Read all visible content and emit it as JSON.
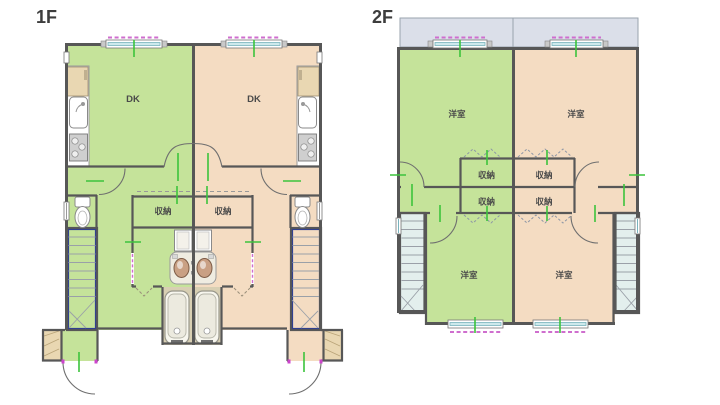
{
  "palette": {
    "unit_a_fill": "#c5e39a",
    "unit_b_fill": "#f4dcc2",
    "wall": "#575757",
    "balcony_fill": "#dbdfe9",
    "stair_fill": "#e3efed",
    "bath_floor": "#d8cfb3",
    "cabinet": "#e9d7b2",
    "tick_green": "#3cc33c",
    "shutter_pink": "#cf6ece",
    "window_glass": "#cde9ec",
    "stair_rail": "#32418f"
  },
  "floor1": {
    "label": "1F",
    "rooms": {
      "dk_left": "DK",
      "dk_right": "DK",
      "storage_left": "収納",
      "storage_right": "収納"
    }
  },
  "floor2": {
    "label": "2F",
    "rooms": {
      "room_upper_left": "洋室",
      "room_upper_right": "洋室",
      "storage_upper_left": "収納",
      "storage_upper_right": "収納",
      "storage_lower_left": "収納",
      "storage_lower_right": "収納",
      "room_lower_left": "洋室",
      "room_lower_right": "洋室"
    }
  }
}
